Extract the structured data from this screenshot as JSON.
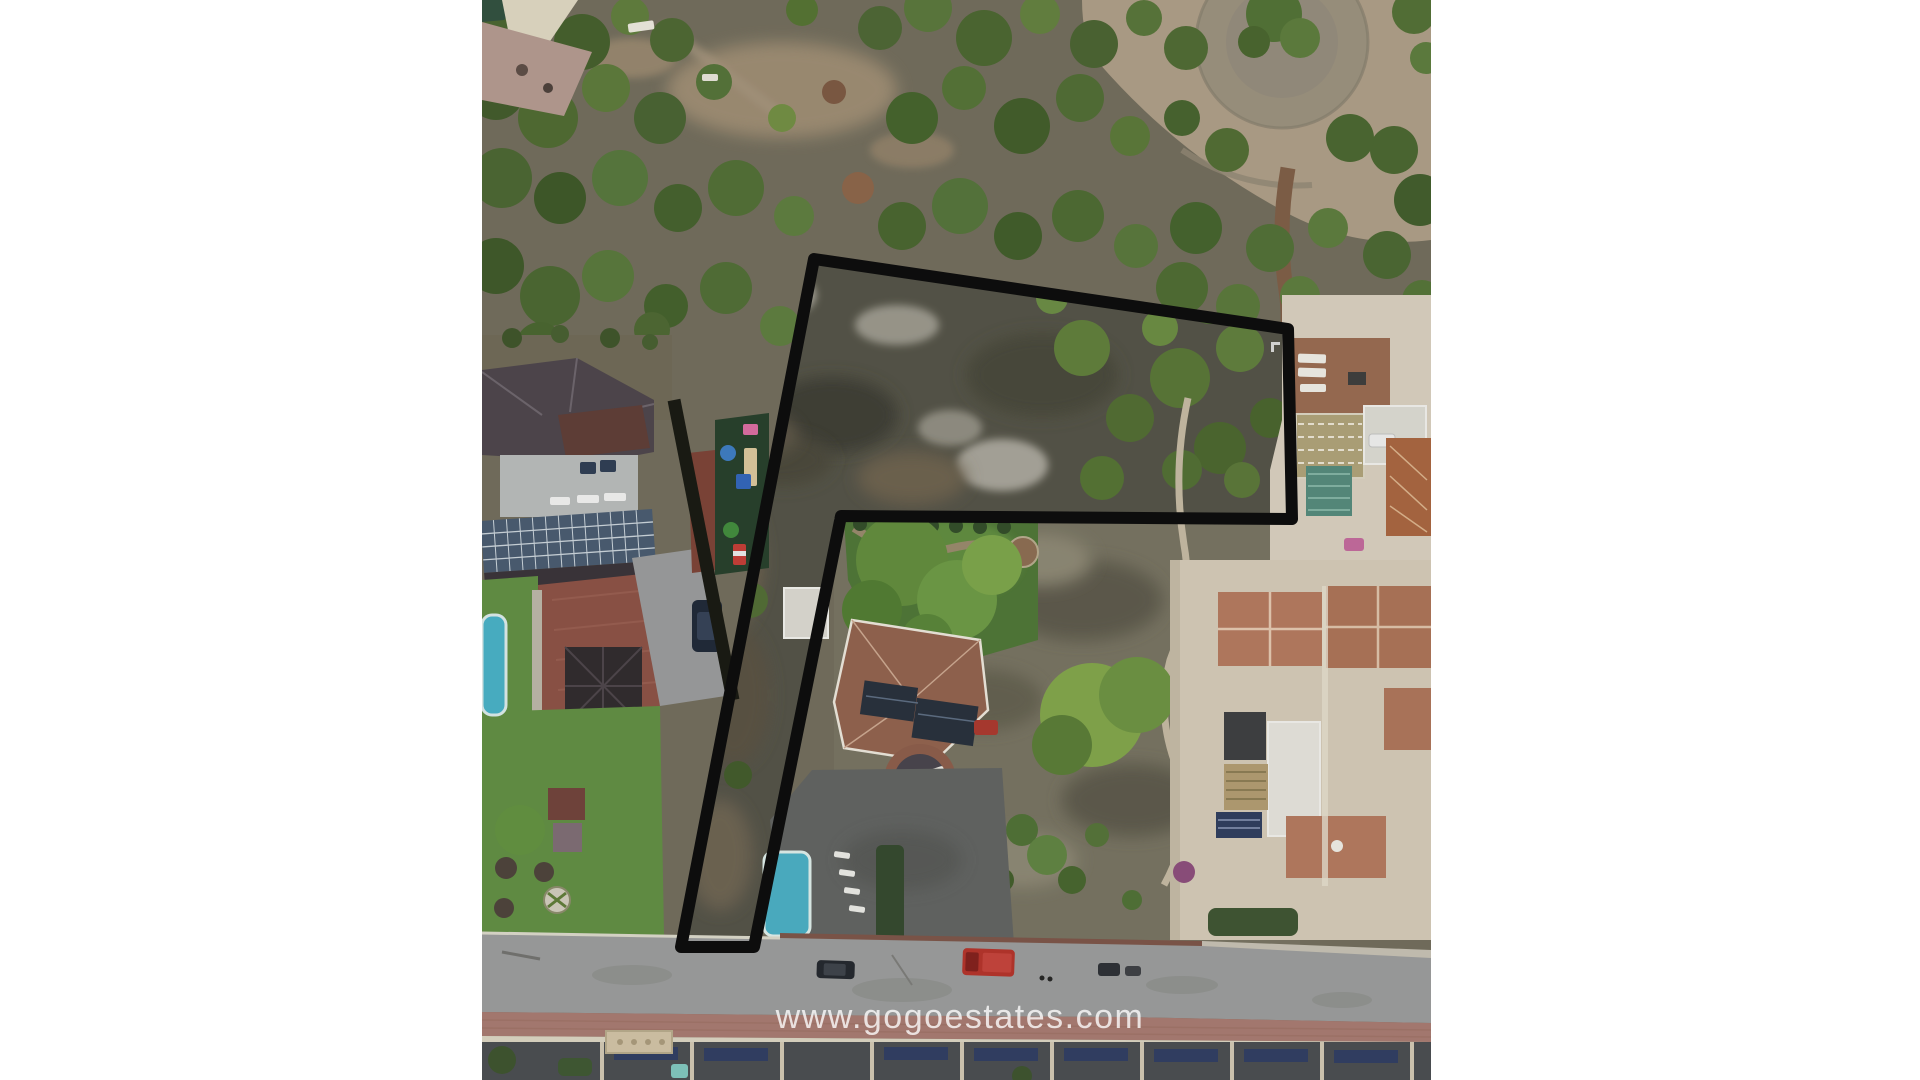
{
  "photo": {
    "kind": "aerial-drone-photo-of-building-plot",
    "watermark": {
      "text": "www.gogoestates.com",
      "color": "rgba(255,255,255,0.78)"
    },
    "plot_outline": {
      "points": "332,259 806,329 810,519 359,516 272,947 199,947",
      "stroke_color": "#0d0d0d",
      "stroke_width": 12
    },
    "palette": {
      "margin_white": "#ffffff",
      "forest_green": "#4d6a32",
      "sand": "#ab9b85",
      "scrub": "#74705f",
      "plot_interior": "#515045",
      "road_gray": "#98999a",
      "sidewalk_red": "#a5786f",
      "pool_blue": "#47acc2",
      "green_pool": "#3a6a4a",
      "roof_terracotta": "#8f5f4b",
      "roof_dark": "#4a4249",
      "bottom_roofs": "#474a4e",
      "awning_navy": "#2d3a60",
      "solar_panel": "#46586e"
    }
  }
}
